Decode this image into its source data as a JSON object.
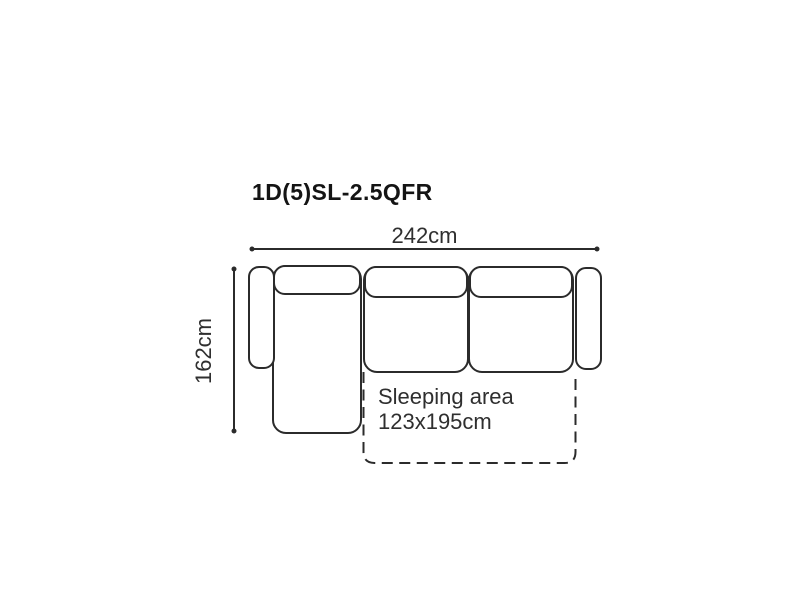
{
  "title": "1D(5)SL-2.5QFR",
  "dimensions": {
    "width": {
      "label": "242cm"
    },
    "depth": {
      "label": "162cm"
    }
  },
  "sleeping_area": {
    "line1": "Sleeping area",
    "line2": "123x195cm"
  },
  "colors": {
    "line": "#2b2b2b",
    "text": "#2f2f2f",
    "title": "#141414",
    "background": "#ffffff"
  }
}
